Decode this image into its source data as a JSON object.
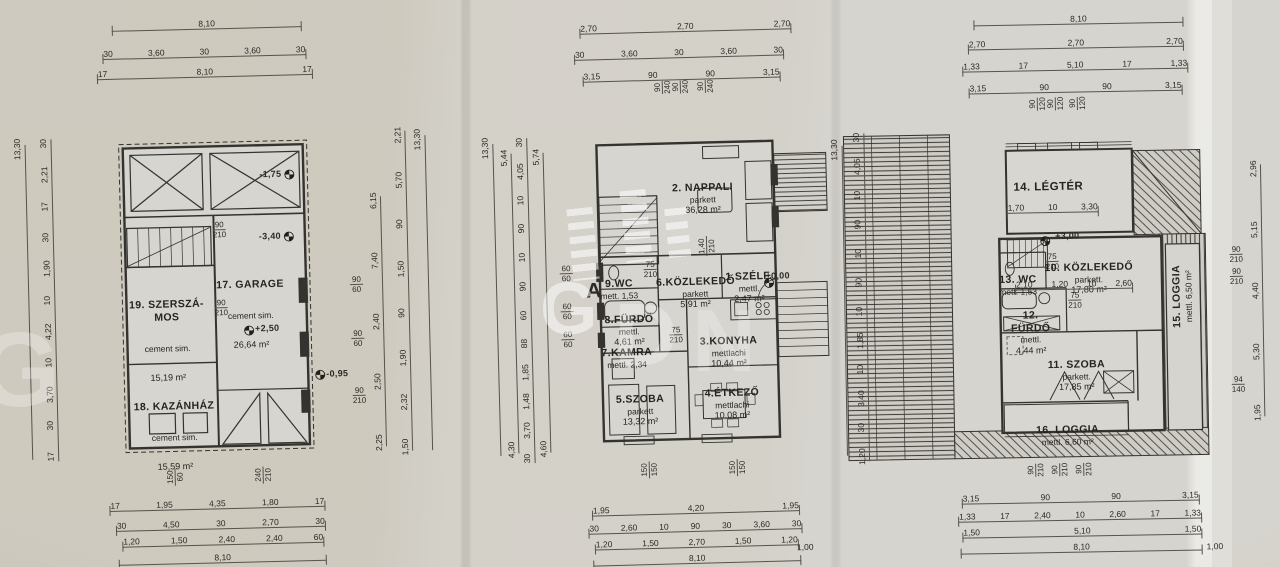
{
  "watermark": {
    "center_letter": "G",
    "second_letter": "D",
    "third_letter": "N",
    "corner_letter": "G"
  },
  "plans": [
    {
      "rooms": [
        {
          "label": "17. GARAGE",
          "material": "cement sim.",
          "area": "26,64 m²"
        },
        {
          "label": "19. SZERSZÁ-\nMOS",
          "material": "cement sim.",
          "area": "15,19 m²"
        },
        {
          "label": "18. KAZÁNHÁZ",
          "material": "cement sim.",
          "area": "15,59 m²"
        }
      ],
      "levels": [
        "-1,75",
        "-3,40",
        "+2,50",
        "-0,95"
      ],
      "door_pairs": [
        [
          "90",
          "210"
        ],
        [
          "90",
          "210"
        ]
      ],
      "top_rows": [
        [
          "8,10"
        ],
        [
          "30",
          "3,60",
          "30",
          "3,60",
          "30"
        ],
        [
          "17",
          "8,10",
          "17"
        ]
      ],
      "bottom_vpairs": [
        [
          "150",
          "60"
        ],
        [
          "240",
          "210"
        ]
      ],
      "bottom_rows": [
        [
          "17",
          "1,95",
          "4,35",
          "1,80",
          "17"
        ],
        [
          "30",
          "4,50",
          "30",
          "2,70",
          "30"
        ],
        [
          "1,20",
          "1,50",
          "2,40",
          "2,40",
          "60"
        ],
        [
          "8,10"
        ]
      ],
      "left_total": "13,30",
      "left_chain": [
        "30",
        "2,21",
        "17",
        "30",
        "1,90",
        "10",
        "4,22",
        "10",
        "3,70",
        "30",
        "17"
      ],
      "right_pairs": [
        [
          "90",
          "60"
        ],
        [
          "90",
          "60"
        ],
        [
          "90",
          "210"
        ]
      ],
      "right_chain_a": [
        "6,15",
        "7,40",
        "2,40",
        "2,50",
        "2,25"
      ],
      "right_chain_b": [
        "2,21",
        "5,70",
        "90",
        "1,50",
        "90",
        "1,90",
        "2,32",
        "1,50"
      ],
      "right_total": "13,30"
    },
    {
      "rooms": [
        {
          "label": "2. NAPPALI",
          "material": "parkett",
          "area": "36,28 m²"
        },
        {
          "label": "9.WC",
          "material": "mett. 1,53",
          "area": ""
        },
        {
          "label": "6.KÖZLEKEDŐ",
          "material": "parkett",
          "area": "5,91 m²"
        },
        {
          "label": "1.SZÉLF.",
          "material": "mettl.",
          "area": "2,47 m²"
        },
        {
          "label": "8.FÜRDŐ",
          "material": "mettl.",
          "area": "4,61 m²"
        },
        {
          "label": "7.KAMRA",
          "material": "mettl. 2,34",
          "area": ""
        },
        {
          "label": "3.KONYHA",
          "material": "mettlachi",
          "area": "10,44 m²"
        },
        {
          "label": "5.SZOBA",
          "material": "parkett",
          "area": "13,32 m²"
        },
        {
          "label": "4.ÉTKEZŐ",
          "material": "mettlachi",
          "area": "10,08 m²"
        }
      ],
      "levels": [
        "±0,00"
      ],
      "section_mark": "A",
      "door_pairs": [
        [
          "75",
          "210"
        ],
        [
          "75",
          "210"
        ]
      ],
      "stair_pair": [
        "1,40",
        "210"
      ],
      "top_rows": [
        [
          "2,70",
          "2,70",
          "2,70"
        ],
        [
          "30",
          "3,60",
          "30",
          "3,60",
          "30"
        ],
        [
          "3,15",
          "90",
          "90",
          "3,15"
        ]
      ],
      "top_vpairs": [
        [
          "90",
          "240"
        ],
        [
          "90",
          "240"
        ],
        [
          "90",
          "240"
        ]
      ],
      "bottom_vpairs": [
        [
          "150",
          "150"
        ],
        [
          "150",
          "150"
        ]
      ],
      "bottom_rows": [
        [
          "1,95",
          "4,20",
          "1,95"
        ],
        [
          "30",
          "2,60",
          "10",
          "90",
          "30",
          "3,60",
          "30"
        ],
        [
          "1,20",
          "1,50",
          "2,70",
          "1,50",
          "1,20"
        ],
        [
          "8,10"
        ]
      ],
      "bottom_extra": "1,00",
      "left_total": "13,30",
      "left_chain_a": [
        "5,44",
        "4,30"
      ],
      "left_chain_b": [
        "30",
        "4,05",
        "10",
        "90",
        "10",
        "90",
        "60",
        "88",
        "1,85",
        "1,48",
        "3,70",
        "30"
      ],
      "left_chain_c": [
        "5,74",
        "4,60"
      ],
      "left_pairs": [
        [
          "60",
          "60"
        ],
        [
          "60",
          "60"
        ],
        [
          "60",
          "60"
        ]
      ]
    },
    {
      "rooms": [
        {
          "label": "14. LÉGTÉR",
          "material": "",
          "area": ""
        },
        {
          "label": "10. KÖZLEKEDŐ",
          "material": "parkett.",
          "area": "17,80 m²"
        },
        {
          "label": "13. WC",
          "material": "mett. 1,53",
          "area": ""
        },
        {
          "label": "12. FÜRDŐ",
          "material": "mettl.",
          "area": "4,44 m²"
        },
        {
          "label": "11. SZOBA",
          "material": "parkett.",
          "area": "17,85 m²"
        },
        {
          "label": "16. LOGGIA",
          "material": "mettl. 6,60 m²",
          "area": ""
        },
        {
          "label": "15. LOGGIA",
          "material": "mettl. 6,50 m²",
          "area": ""
        }
      ],
      "levels": [
        "+3,00"
      ],
      "inner_row_legter": [
        "1,70",
        "10",
        "3,30"
      ],
      "inner_row_mid": [
        "2,10",
        "1,20",
        "10",
        "2,60"
      ],
      "door_pairs": [
        [
          "75",
          "210"
        ],
        [
          "75",
          "210"
        ]
      ],
      "top_rows": [
        [
          "8,10"
        ],
        [
          "2,70",
          "2,70",
          "2,70"
        ],
        [
          "1,33",
          "17",
          "5,10",
          "17",
          "1,33"
        ],
        [
          "3,15",
          "90",
          "90",
          "3,15"
        ]
      ],
      "top_vpairs": [
        [
          "90",
          "120"
        ],
        [
          "90",
          "120"
        ],
        [
          "90",
          "120"
        ]
      ],
      "bottom_vpairs": [
        [
          "90",
          "210"
        ],
        [
          "90",
          "210"
        ],
        [
          "90",
          "210"
        ]
      ],
      "bottom_rows": [
        [
          "3,15",
          "90",
          "90",
          "3,15"
        ],
        [
          "1,33",
          "17",
          "2,40",
          "10",
          "2,60",
          "17",
          "1,33"
        ],
        [
          "1,50",
          "5,10",
          "1,50"
        ],
        [
          "8,10"
        ]
      ],
      "bottom_extra": "1,00",
      "left_total": "13,30",
      "left_chain": [
        "30",
        "4,05",
        "10",
        "90",
        "10",
        "90",
        "10",
        "1,85",
        "10",
        "3,40",
        "30",
        "1,20"
      ],
      "right_chain": [
        "2,96",
        "5,15",
        "4,40",
        "5,30",
        "1,95"
      ],
      "right_pairs": [
        [
          "90",
          "210"
        ],
        [
          "90",
          "210"
        ],
        [
          "94",
          "140"
        ]
      ]
    }
  ]
}
